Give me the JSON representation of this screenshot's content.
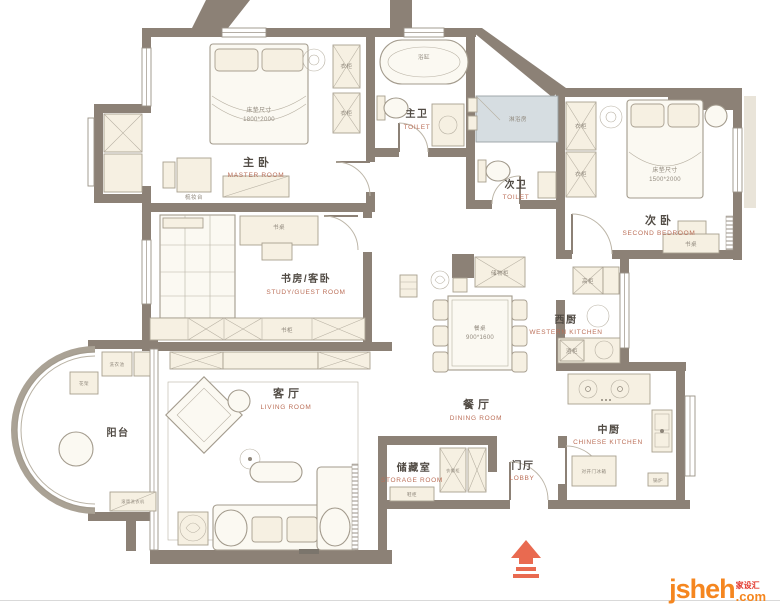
{
  "palette": {
    "wall": "#8c8176",
    "furniture_fill": "#f6f0e2",
    "accent_red": "#e96a50",
    "label_zh": "#514b44",
    "label_en": "#bb6f58",
    "logo_orange": "#f5861f",
    "logo_red": "#e2362b"
  },
  "rooms": {
    "master": {
      "zh": "主卧",
      "en": "MASTER ROOM"
    },
    "master_bath": {
      "zh": "主卫",
      "en": "TOILET"
    },
    "second_bath": {
      "zh": "次卫",
      "en": "TOILET"
    },
    "second_bedroom": {
      "zh": "次卧",
      "en": "SECOND BEDROOM"
    },
    "study": {
      "zh": "书房/客卧",
      "en": "STUDY/GUEST ROOM"
    },
    "west_kitchen": {
      "zh": "西厨",
      "en": "WESTERN KITCHEN"
    },
    "living": {
      "zh": "客厅",
      "en": "LIVING ROOM"
    },
    "dining": {
      "zh": "餐厅",
      "en": "DINING ROOM"
    },
    "chinese_kitchen": {
      "zh": "中厨",
      "en": "CHINESE KITCHEN"
    },
    "storage": {
      "zh": "储藏室",
      "en": "STORAGE ROOM"
    },
    "lobby": {
      "zh": "门厅",
      "en": "LOBBY"
    },
    "balcony": {
      "zh": "阳台"
    }
  },
  "furniture": {
    "bed_size_label": "床垫尺寸",
    "master_bed_size": "1800*2000",
    "second_bed_size": "1500*2000",
    "dining_table": "餐桌",
    "dining_table_size": "900*1600",
    "bathtub": "浴缸",
    "shower": "淋浴房",
    "dresser": "梳妆台",
    "desk": "书桌",
    "bookcase": "书柜",
    "wardrobe": "衣柜",
    "tall_cabinet": "高柜",
    "wine_cabinet": "酒柜",
    "storage_cabinet": "储物柜",
    "shoe_cabinet": "鞋柜",
    "cloak_cabinet": "衣帽柜",
    "fridge": "对开门冰箱",
    "boiler": "锅炉",
    "laundry_sink": "洗衣池",
    "flower_rack": "花架",
    "washer": "滚筒洗衣机"
  },
  "branding": {
    "logo_text": "jsheh",
    "logo_tld": ".com",
    "logo_badge": "家设汇"
  }
}
